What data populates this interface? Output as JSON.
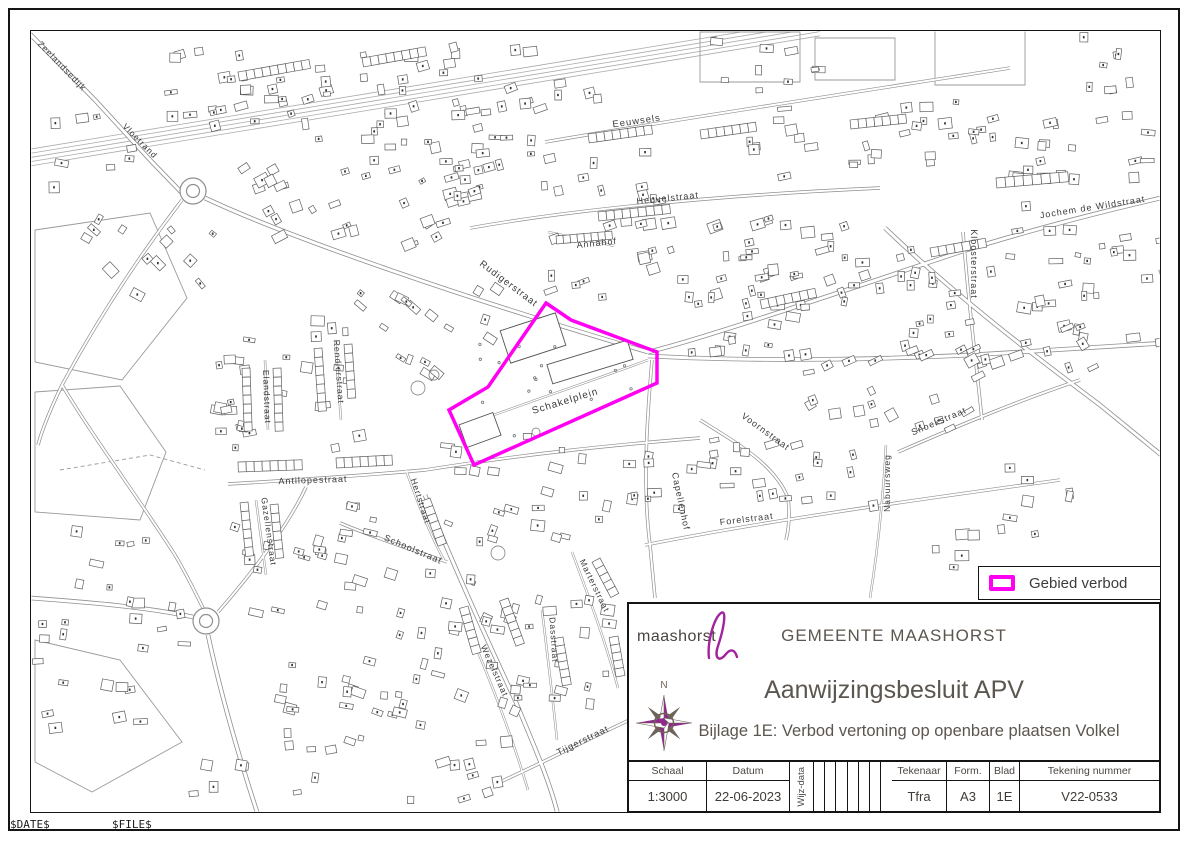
{
  "page": {
    "date_var": "$DATE$",
    "file_var": "$FILE$"
  },
  "legend": {
    "label": "Gebied verbod",
    "swatch_color": "#ff00f2"
  },
  "title_block": {
    "logo_text": "maashorst",
    "municipality": "GEMEENTE MAASHORST",
    "title": "Aanwijzingsbesluit APV",
    "subtitle": "Bijlage 1E: Verbod vertoning op openbare plaatsen Volkel",
    "compass_label": "N",
    "table": {
      "schaal_label": "Schaal",
      "schaal_value": "1:3000",
      "datum_label": "Datum",
      "datum_value": "22-06-2023",
      "wijz_label": "Wijz-data",
      "tekenaar_label": "Tekenaar",
      "tekenaar_value": "Tfra",
      "form_label": "Form.",
      "form_value": "A3",
      "blad_label": "Blad",
      "blad_value": "1E",
      "nummer_label": "Tekening nummer",
      "nummer_value": "V22-0533"
    }
  },
  "map": {
    "prohibition_area_color": "#ff00f2",
    "prohibition_area_points": "546,303 571,320 657,352 657,383 474,465 449,410 488,387",
    "street_labels": [
      {
        "text": "Zeelandsedijk",
        "x": 60,
        "y": 68,
        "rot": 46,
        "size": 8.5
      },
      {
        "text": "Vloetrand",
        "x": 138,
        "y": 143,
        "rot": 45,
        "size": 8.5
      },
      {
        "text": "Eeuwsels",
        "x": 637,
        "y": 124,
        "rot": -8,
        "size": 9.5
      },
      {
        "text": "Heuvelstraat",
        "x": 668,
        "y": 201,
        "rot": -6,
        "size": 9
      },
      {
        "text": "Jochem de Wildstraat",
        "x": 1093,
        "y": 210,
        "rot": -9,
        "size": 9
      },
      {
        "text": "Annahof",
        "x": 597,
        "y": 246,
        "rot": -6,
        "size": 9
      },
      {
        "text": "Rudigerstraat",
        "x": 507,
        "y": 286,
        "rot": 37,
        "size": 9.5
      },
      {
        "text": "Kloosterstraat",
        "x": 971,
        "y": 264,
        "rot": 90,
        "size": 9
      },
      {
        "text": "Schakelplein",
        "x": 566,
        "y": 404,
        "rot": -17,
        "size": 10
      },
      {
        "text": "Voornstraat",
        "x": 764,
        "y": 434,
        "rot": 36,
        "size": 9
      },
      {
        "text": "Snoekstraat",
        "x": 940,
        "y": 424,
        "rot": -23,
        "size": 9
      },
      {
        "text": "Nabuursweg",
        "x": 890,
        "y": 483,
        "rot": -90,
        "size": 8.5
      },
      {
        "text": "Elandstraat",
        "x": 264,
        "y": 397,
        "rot": 88,
        "size": 8.5
      },
      {
        "text": "Rendierstraat",
        "x": 336,
        "y": 372,
        "rot": 86,
        "size": 8.5
      },
      {
        "text": "Antilopestraat",
        "x": 313,
        "y": 483,
        "rot": -2,
        "size": 9
      },
      {
        "text": "Hertstraat",
        "x": 418,
        "y": 502,
        "rot": 72,
        "size": 8.5
      },
      {
        "text": "Gazellenstraat",
        "x": 266,
        "y": 532,
        "rot": 82,
        "size": 8.5
      },
      {
        "text": "Capellenhof",
        "x": 678,
        "y": 502,
        "rot": 78,
        "size": 9
      },
      {
        "text": "Forelstraat",
        "x": 747,
        "y": 522,
        "rot": -7,
        "size": 9
      },
      {
        "text": "Schoolstraat",
        "x": 412,
        "y": 552,
        "rot": 23,
        "size": 9
      },
      {
        "text": "Marterstraat",
        "x": 592,
        "y": 587,
        "rot": 64,
        "size": 8.5
      },
      {
        "text": "Dasstraat",
        "x": 551,
        "y": 640,
        "rot": 86,
        "size": 8.5
      },
      {
        "text": "Wezelstraat",
        "x": 492,
        "y": 672,
        "rot": 66,
        "size": 8.5
      },
      {
        "text": "Tijgerstraat",
        "x": 584,
        "y": 743,
        "rot": -26,
        "size": 9
      }
    ]
  }
}
